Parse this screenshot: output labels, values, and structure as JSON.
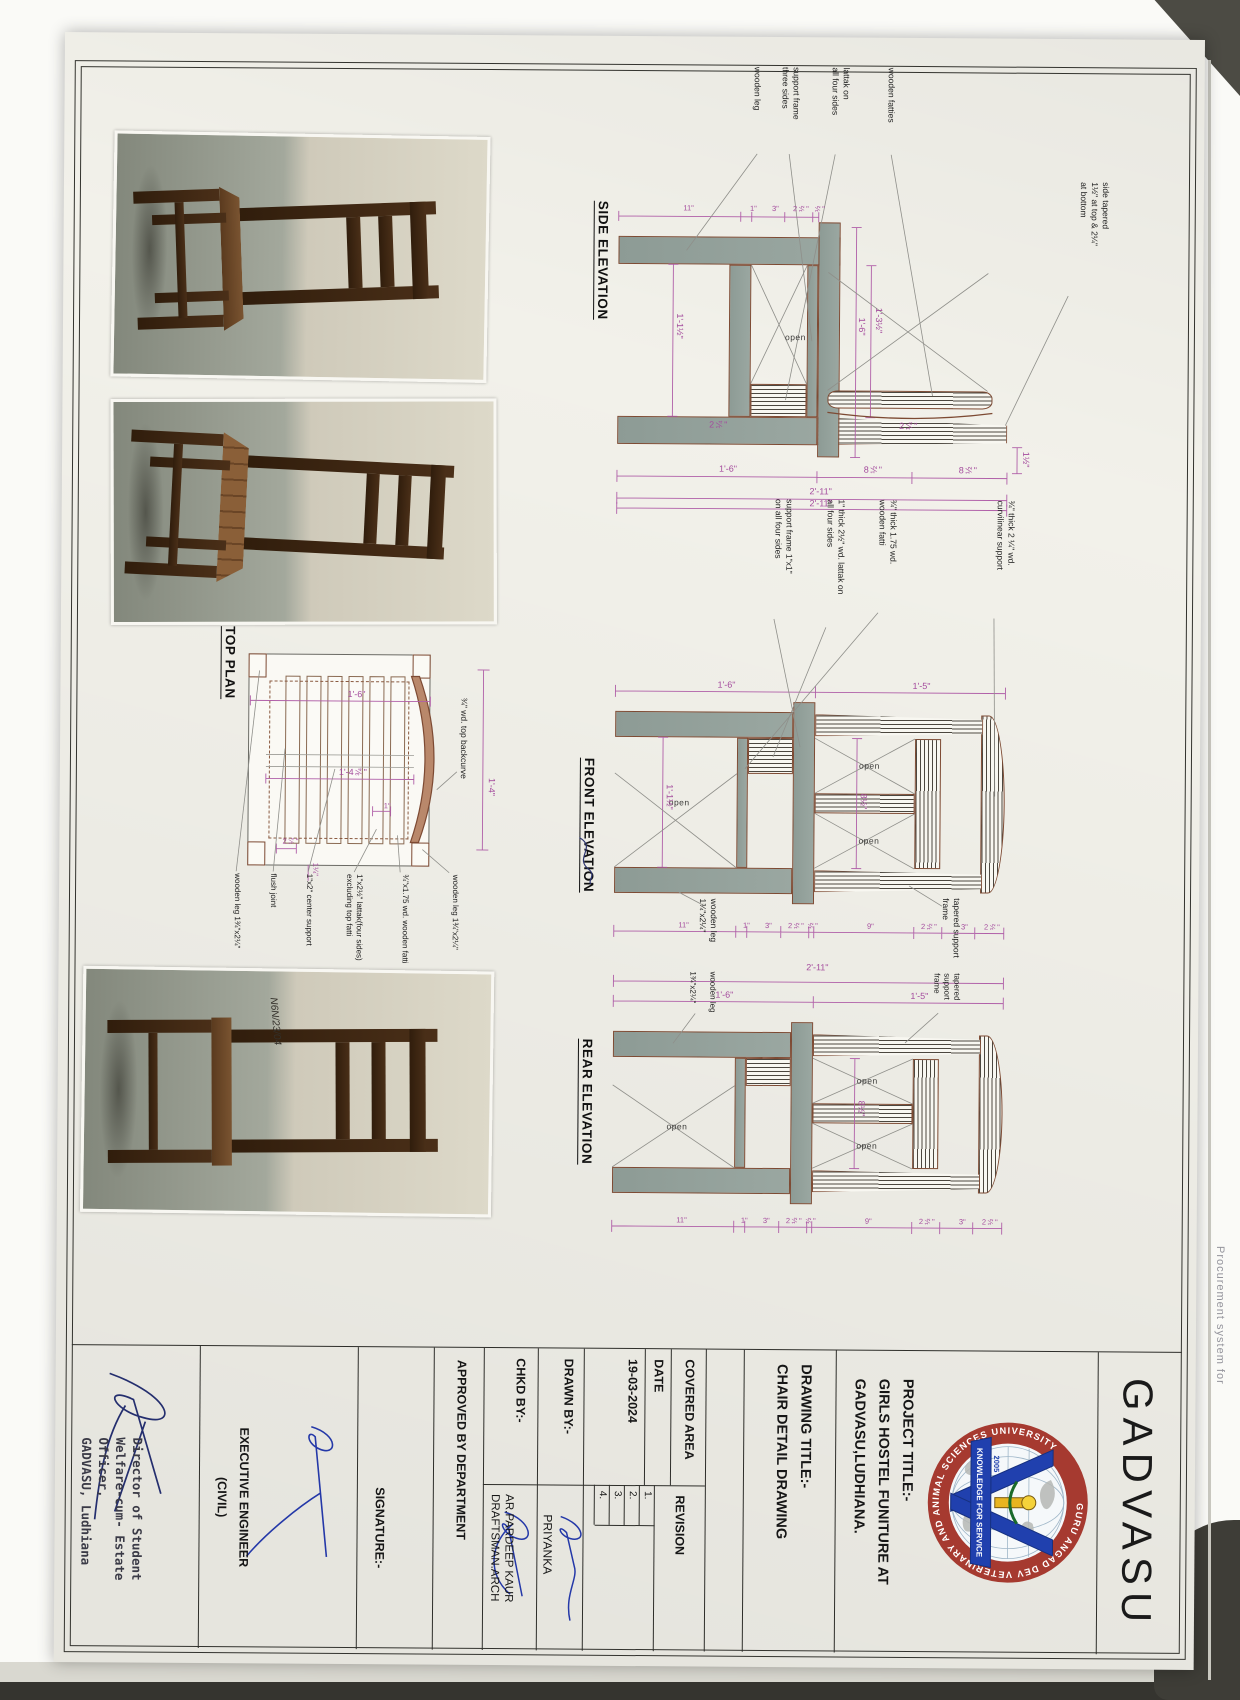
{
  "page": {
    "edge_text": "Procurement system for"
  },
  "org": "GADVASU",
  "logo": {
    "ring": "GURU ANGAD DEV VETERINARY AND ANIMAL SCIENCES UNIVERSITY",
    "banner": "KNOWLEDGE FOR SERVICE",
    "year": "2005"
  },
  "tb": {
    "project_label": "PROJECT TITLE:-",
    "project1": "GIRLS HOSTEL FUNITURE AT",
    "project2": "GADVASU,LUDHIANA.",
    "drawing_label": "DRAWING TITLE:-",
    "drawing_title": "CHAIR DETAIL DRAWING",
    "covered": "COVERED AREA",
    "date_label": "DATE",
    "date": "19-03-2024",
    "revision": "REVISION",
    "rev": [
      "1.",
      "2.",
      "3.",
      "4."
    ],
    "drawn_label": "DRAWN BY:-",
    "drawn": "PRIYANKA",
    "chkd_label": "CHKD BY:-",
    "chkd1": "AR.PARDEEP KAUR",
    "chkd2": "DRAFTSMAN.ARCH",
    "approved": "APPROVED BY DEPARTMENT",
    "signature": "SIGNATURE:-",
    "exec1": "EXECUTIVE ENGINEER",
    "exec2": "(CIVIL)",
    "stamp": [
      "Director of Student",
      "Welfare-cum- Estate",
      "Officer,",
      "GADVASU, Ludhiana"
    ]
  },
  "side": {
    "title": "SIDE ELEVATION",
    "note1": "side tapered",
    "note2": "1½\" at top & 2¼\"",
    "note3": "at bottom",
    "lab1": "wooden fatties",
    "lab2a": "lattak on",
    "lab2b": "all four sides",
    "lab3a": "support frame",
    "lab3b": "three sides",
    "lab4": "wooden leg",
    "open": "open",
    "d_top": "1½\"",
    "chain_fine": [
      "½\"",
      "2½\"",
      "3\"",
      "1\"",
      "11\""
    ],
    "chain_right": [
      "8½\"",
      "8½\"",
      "1'-6\""
    ],
    "overall": "2'-11\"",
    "h1": "1'-3½\"",
    "h2": "1'-6\"",
    "h3": "1'-1½\"",
    "leg": "2¼\""
  },
  "front": {
    "title": "FRONT ELEVATION",
    "lab1a": "¾\" thick 2 ¼\" wd.",
    "lab1b": "curvilinear support",
    "lab2a": "¾\" thick 1.75 wd.",
    "lab2b": "wooden fatti",
    "lab3a": "1\" thick 2½\" wd. lattak on",
    "lab3b": "all four sides",
    "lab4a": "support frame 1\"x1\"",
    "lab4b": "on all four sides",
    "lab5a": "tapered support",
    "lab5b": "frame",
    "lab6a": "wooden leg",
    "lab6b": "1¾\"x2¼\"",
    "open": "open",
    "overall": "2'-11\"",
    "upper": "1'-5\"",
    "lower": "1'-6\"",
    "chain": [
      "2½\"",
      "3\"",
      "2½\"",
      "9\"",
      "½\"",
      "2½\"",
      "3\"",
      "1\"",
      "11\""
    ],
    "h1": "8½\"",
    "h2": "1'-1½\""
  },
  "rear": {
    "title": "REAR ELEVATION",
    "lab1a": "tapered support",
    "lab1b": "frame",
    "lab2a": "wooden leg",
    "lab2b": "1¾\"x2¼\"",
    "open": "open",
    "overall": "2'-11\"",
    "upper": "1'-5\"",
    "lower": "1'-6\"",
    "chain": [
      "2½\"",
      "3\"",
      "2½\"",
      "9\"",
      "½\"",
      "2½\"",
      "3\"",
      "1\"",
      "11\""
    ],
    "h1": "8½\""
  },
  "plan": {
    "title": "TOP PLAN",
    "curve_label": "¾\" wd. top backcurve",
    "d_top": "1'-4\"",
    "d_left": "1'-6\"",
    "d_inner": "1'-4¾\"",
    "d_small1": "1\"",
    "d_small2": "2¼\"",
    "d_small3": "1¼\"",
    "r1a": "wooden leg",
    "r1b": "1¾\"x2¼\"",
    "r2": "¾\"x1.75 wd. wooden fatti",
    "r3a": "1\"x2½\" lattak(four sides)",
    "r3b": "excluding top fatti",
    "r4": "1\"x2\" center support",
    "r5": "flush joint",
    "r6a": "wooden leg",
    "r6b": "1¾\"x2¼\""
  },
  "photos": {
    "mark": "N6N/23/04"
  }
}
